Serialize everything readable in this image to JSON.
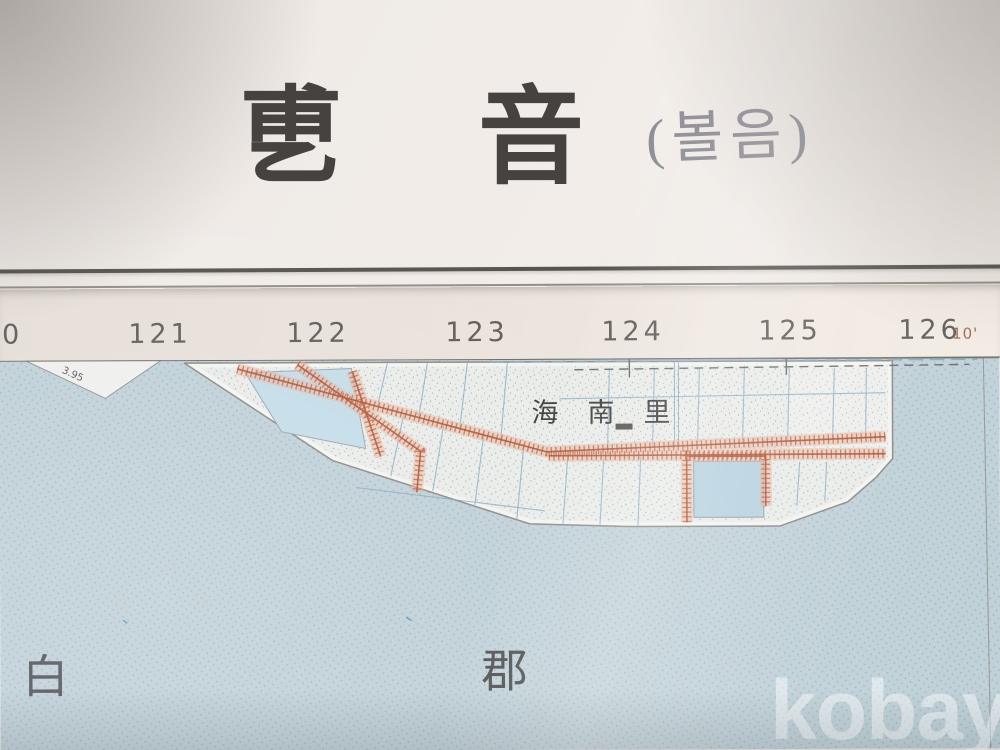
{
  "title_block": {
    "hanja_char_1": "乶",
    "hanja_char_2": "音",
    "hanja_title_full": "乶音",
    "handwritten_annotation": "(볼음)"
  },
  "coordinate_strip": {
    "tick_labels": [
      "20",
      "121",
      "122",
      "123",
      "124",
      "125",
      "126"
    ],
    "minute_label": "10'"
  },
  "map": {
    "village_label": "海南里",
    "left_area_char": "白",
    "center_area_char": "郡",
    "spot_elevation": "3.95"
  },
  "watermark": {
    "text": "kobay"
  },
  "colors": {
    "paper": "#f0ebe7",
    "strip": "#eae2db",
    "water": "#c0d1d8",
    "land": "#eaece9",
    "dike_red": "#c2613f",
    "reservoir_blue": "#bdd8e4",
    "grid_blue": "#7ea6bf",
    "title_ink": "#454240",
    "pencil": "#8d8b93"
  }
}
